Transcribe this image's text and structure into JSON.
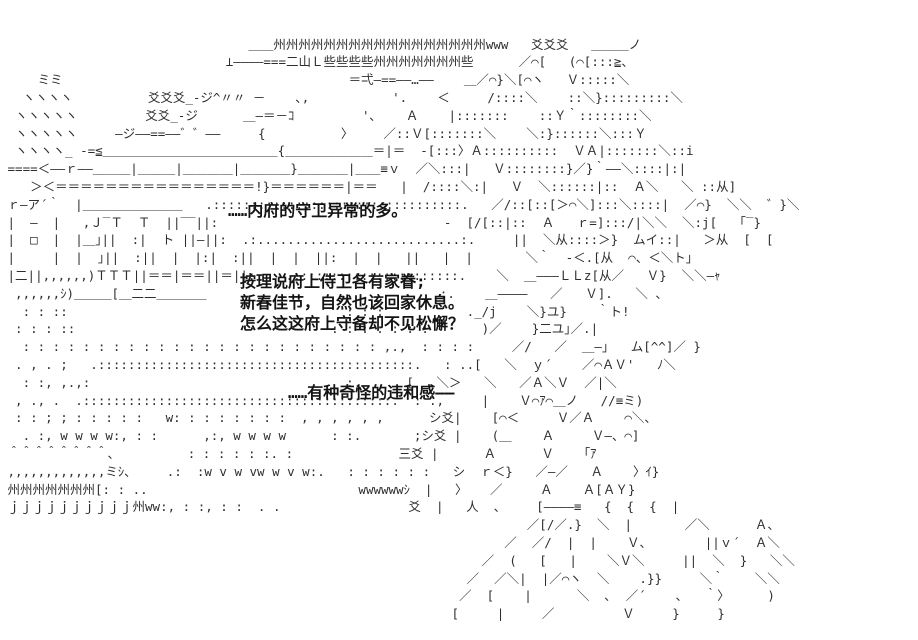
{
  "meta": {
    "background_color": "#ffffff",
    "ink_color": "#2e2e2e",
    "dialogue_color": "#141414",
    "description": "Monochrome ASCII-art (AA) visual-novel scene: a guarded mansion on the left, a long-haired robed figure on the right, with narration text"
  },
  "dialogue": {
    "line1": "……内府的守卫异常的多。",
    "line2": "按理说府上侍卫各有家眷;",
    "line3": "新春佳节，自然也该回家休息。",
    "line4": "怎么这这府上守备却不见松懈？",
    "line5": "……有种奇怪的违和感——"
  },
  "ascii_art": {
    "lines": [
      "",
      "",
      "                                 ＿＿州州州州州州州州州州州州州州州州州www   爻爻爻   ＿＿＿ノ",
      "                              ⊥――――===二山Ｌ些些些些州州州州州州州些      ／⌒[   (⌒[:::≧、",
      "     ミミ                                      ＝弌―==――…――    ＿／⌒}＼[⌒ヽ   Ｖ:::::＼",
      "   ヽヽヽヽ          爻爻爻_-ジ^〃〃 －    ､,           '.    ＜     /::::＼    ::＼}:::::::::＼",
      "  ヽヽヽヽヽ         爻爻_-ジ      ＿―＝－ｺ         '､    Ａ    |:::::::    ::Ｙ｀::::::::＼",
      "  ヽヽヽヽヽ     ―ジ――==――゛゛――     {          〉    ／::Ｖ[:::::::＼    ＼:}::::::＼:::Ｙ",
      "  ヽヽヽヽ_ -=≦＿＿＿＿＿＿＿＿＿＿＿＿＿＿{＿＿＿＿＿＿＿＝|＝  -[:::〉Ａ::::::::::  ＶＡ|:::::::＼::i",
      " ====＜――ｒ――＿＿＿|＿＿＿|＿＿＿＿|＿＿＿＿}＿＿＿＿|＿＿≡ｖ  ／＼:::|   Ｖ::::::::}／}｀――＼::::|:|",
      "    ＞＜＝＝＝＝＝＝＝＝＝＝＝＝＝＝＝＝!}＝＝＝＝＝＝|＝＝   |  /::::＼:|   Ｖ  ＼::::::|::  Ａ＼   ＼ ::从]",
      " ｒ―ア´｀  |＿＿＿＿＿＿＿＿   .:::::::::::::::::::::::::::::::::.   ／/::[::[＞⌒＼]:::＼::::|  ／⌒}  ＼＼  ゛}＼",
      " |  ―  |   ,Ｊ‾Ｔ  Ｔ  ||‾‾||:                              -  [/[::|::  Ａ   ｒ=]:::/|＼＼  ＼:j[   ｢‾}",
      " |  □  |  |＿｣||  :|  ト ||―||:  .:...........................:.     ||  ＼从::::＞}  ムイ::|   ＞从  [  [",
      " |     |  |  ｣||  :||  |  |:|  :||  |  |  ||:  |  |   ||   |  |       ＼｀  ‐＜.[从  ⌒、＜＼ト｣",
      " |二||,,,,,,)ＴＴＴ||＝＝|＝＝||＝||:    .::::::::::::::::::::::.    ＼  ＿―――ＬＬz[从／   Ｖ}  ＼＼―ｬ",
      "  ,,,,,,ｼ)＿＿＿[＿二二＿＿＿＿                               :.    ＿――――   ／   Ｖ].   ＼ 、",
      "   : : ::                                     : : :           ._/j    ＼}ユ}    ｀ト!",
      "  : : : ::                                  : : : : : : :       )／    }二ユ｣／.|",
      "   : : : : : : : : : : : : : : : : : : : : : : : : ,.,  : : : :     ／/   ／  ＿―｣   ム[^^]／ }",
      "  . , . ;   .::::::::::::::::::::::::::::::::::::::::::.   : ..[   ＼  ｙ´    ／⌒ＡＶ'   ﾉ＼",
      "   : :, ,.,:                                  :.      [   ＼＞   ＼   ／Ａ＼Ｖ  ／|＼",
      "  , ., .  .:::::::::::::::::::::::::::::::::::::::::.  : .,     |    Ｖ⌒ｱ⌒＿ノ   //≡ミ)",
      "  : : ; ; : : : : :   w: : : : : : : :  , , , , , ,      シ爻|    [⌒＜     Ｖ／Ａ    ⌒＼、",
      "   . :, w w w w:, : :      ,:, w w w w      : :.       ;シ爻 |    (＿    Ａ     Ｖ―、⌒]",
      " ＾＾＾＾＾＾＾＾、         : : : : : :. :              三爻 |      Ａ      Ｖ    ｢ｱ",
      " ,,,,,,,,,,,,,ミｼ、    .:  :w v w vw w v w:.   : : : : : :   シ  ｒ＜}   ／―／   Ａ    〉ｲ}",
      " 州州州州州州州[: : ..                            wwwwwwｼ  |   〉   ／     Ａ    Ａ[ＡＹ}",
      " ｊｊｊｊｊｊｊｊｊｊ州ww:, : :, : :  . .                 爻  |   人  、    [――――≡   {  {  {  |",
      "                                                                      ／[/／.}  ＼  |       ／＼      Ａ、",
      "                                                                   ／  ／/  |  |    Ｖ、       ||ｖ´  Ａ＼",
      "                                                                ／  (   [   |    ＼Ｖ＼     ||  ＼  }   ＼＼",
      "                                                              ／  ／＼|  |／⌒ヽ  ＼    .}}     ＼｀    ＼＼",
      "                                                             ／  [    |      ＼  ､  ／´    ､   ｀〉     )",
      "                                                            [     |     ／         Ｖ     }     }",
      "",
      ""
    ]
  }
}
